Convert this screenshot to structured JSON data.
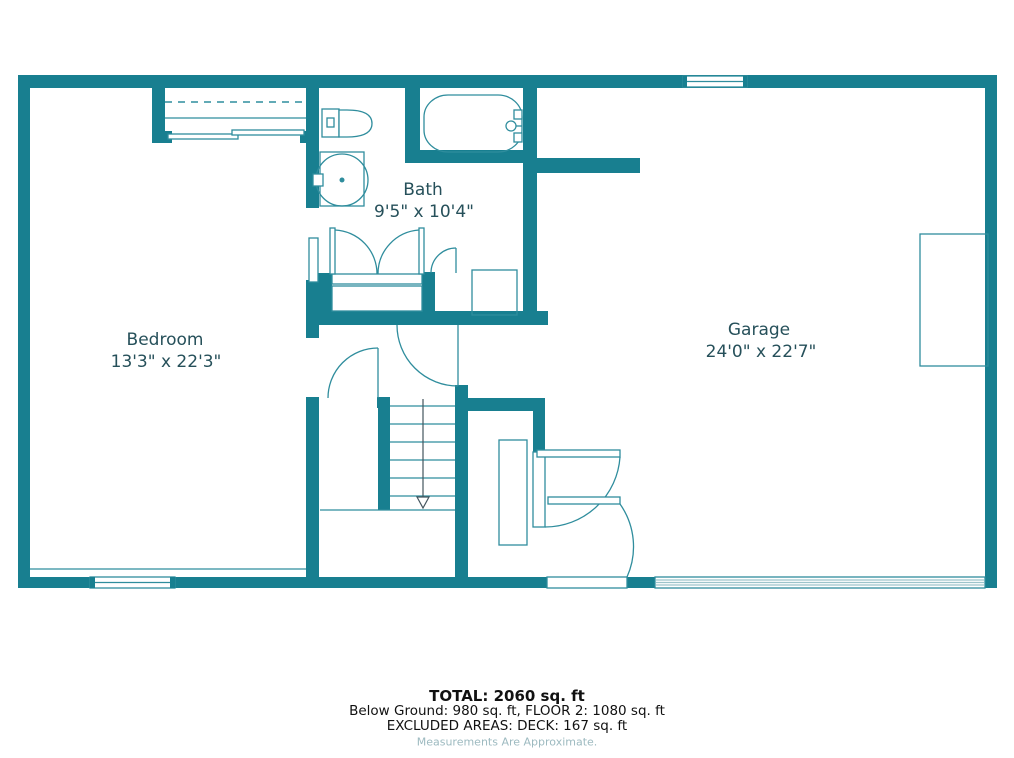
{
  "colors": {
    "wall": "#187F90",
    "line": "#2F8D9D",
    "light_line": "#9CC4CB",
    "label": "#26505A",
    "footer_text": "#111111",
    "footer_muted": "#9DBAC0",
    "background": "#FFFFFF",
    "dark_line": "#44555E"
  },
  "rooms": {
    "bath": {
      "name": "Bath",
      "dims": "9'5\" x 10'4\""
    },
    "bedroom": {
      "name": "Bedroom",
      "dims": "13'3\" x 22'3\""
    },
    "garage": {
      "name": "Garage",
      "dims": "24'0\" x 22'7\""
    }
  },
  "footer": {
    "total": "TOTAL: 2060 sq. ft",
    "floors": "Below Ground: 980 sq. ft, FLOOR 2: 1080 sq. ft",
    "excluded": "EXCLUDED AREAS: DECK: 167 sq. ft",
    "disclaimer": "Measurements Are Approximate."
  }
}
